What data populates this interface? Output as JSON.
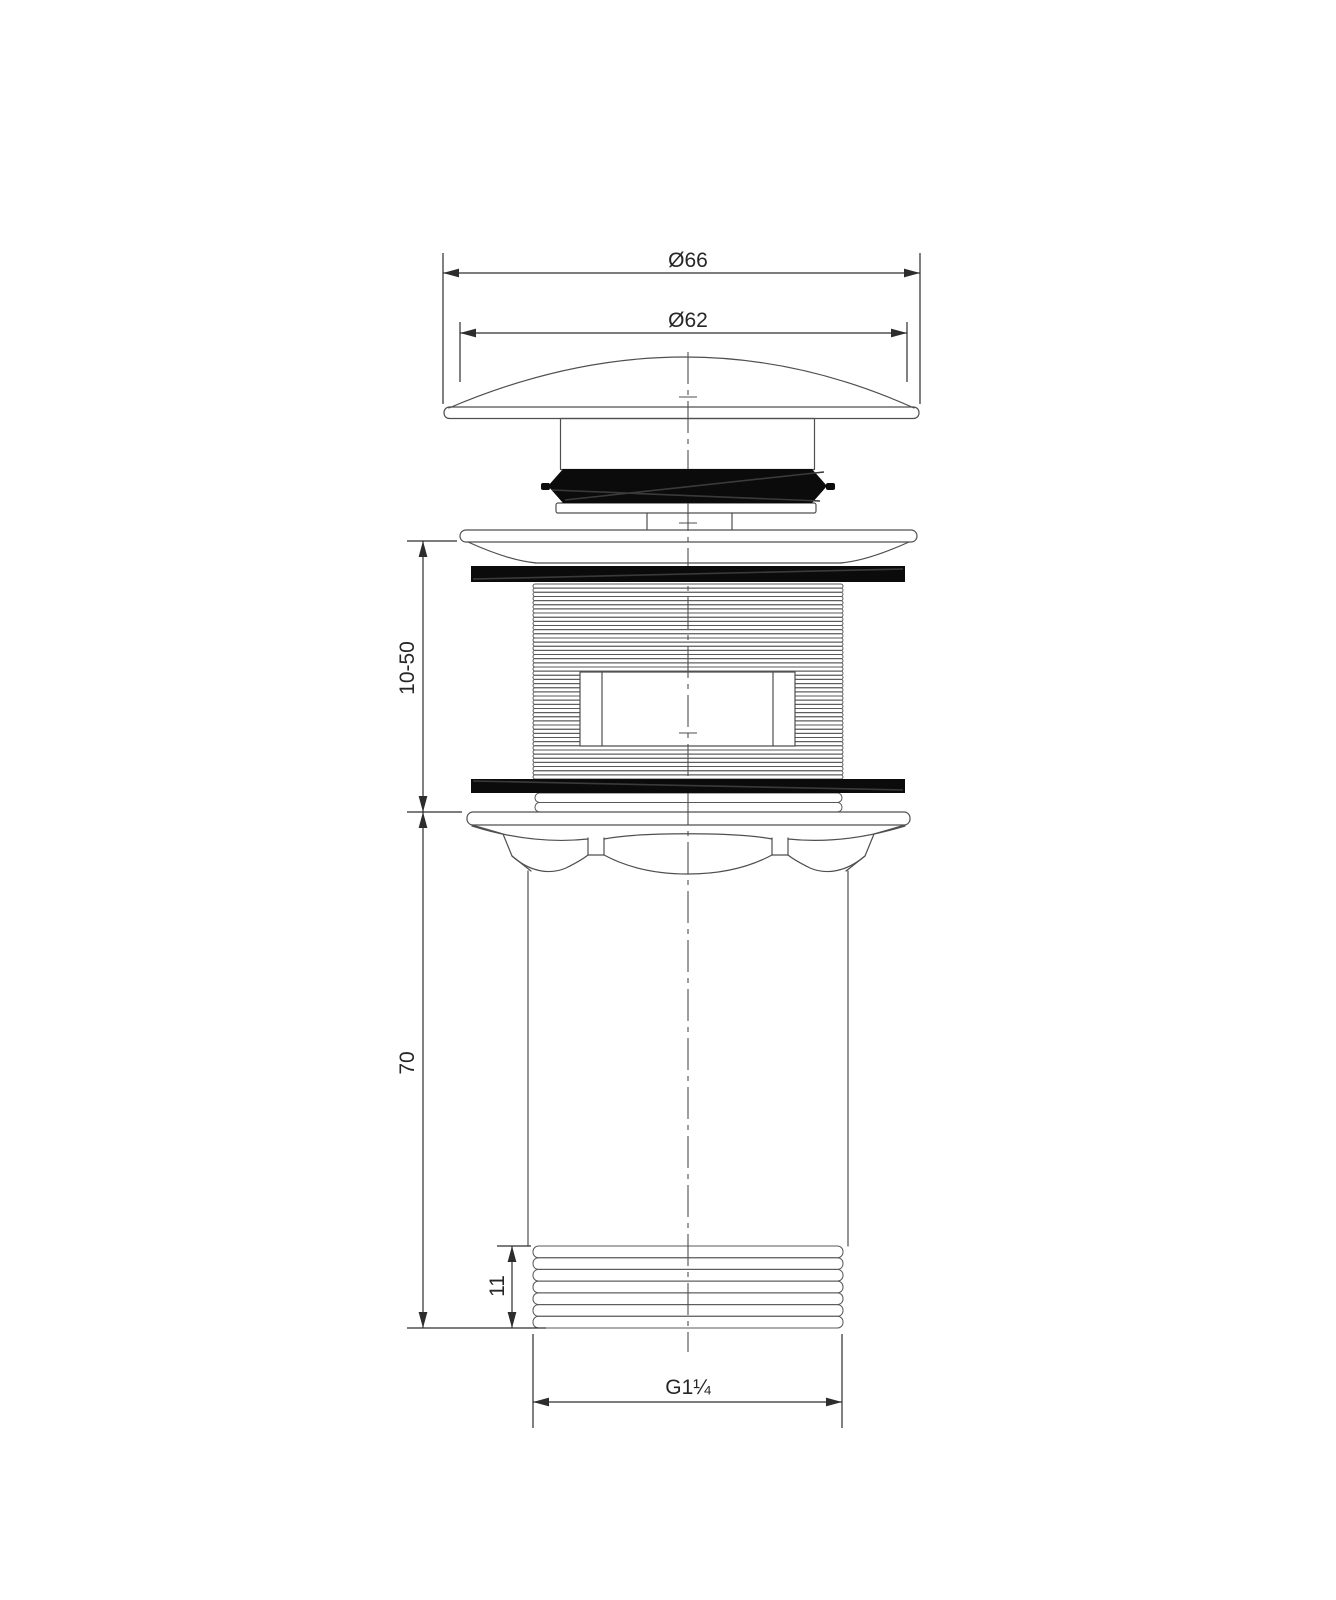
{
  "drawing": {
    "dimensions": {
      "cap_outer_diameter": "Ø66",
      "cap_inner_diameter": "Ø62",
      "clamping_range": "10-50",
      "body_length": "70",
      "lower_thread_length": "11",
      "thread_size": "G1¼"
    },
    "colors": {
      "background": "#ffffff",
      "line": "#4f4f4f",
      "dimension": "#2d2d2d",
      "seal_fill": "#0b0b0b"
    }
  }
}
